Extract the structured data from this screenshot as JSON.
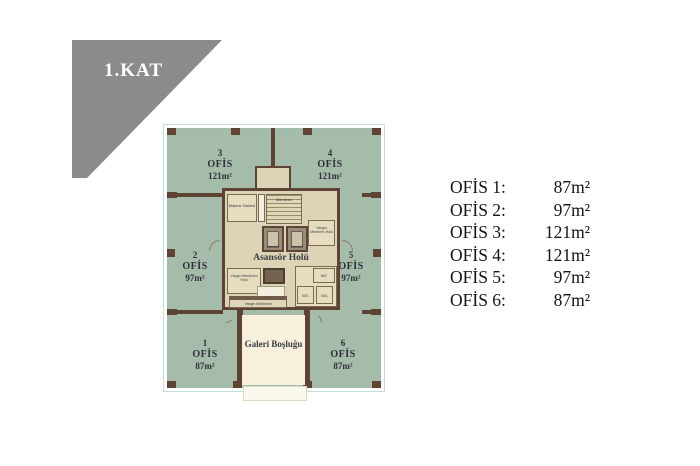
{
  "banner": {
    "label": "1.KAT"
  },
  "plan": {
    "offices": [
      {
        "num": "3",
        "type": "OFİS",
        "area": "121m²"
      },
      {
        "num": "4",
        "type": "OFİS",
        "area": "121m²"
      },
      {
        "num": "2",
        "type": "OFİS",
        "area": "97m²"
      },
      {
        "num": "5",
        "type": "OFİS",
        "area": "97m²"
      },
      {
        "num": "1",
        "type": "OFİS",
        "area": "87m²"
      },
      {
        "num": "6",
        "type": "OFİS",
        "area": "87m²"
      }
    ],
    "core": {
      "hall": "Asansör Holü",
      "machine_room": "Makine Dairesi",
      "stairs": "Merdiven",
      "elevator": "Asansör",
      "fire_hall": "Yangın Merdiveni Holü",
      "fire_stairs": "Yangın Merdiveni",
      "shaft_hall": "Yangın Merdiven Holü",
      "wc": "WC"
    },
    "gallery": "Galeri Boşluğu"
  },
  "legend": {
    "rows": [
      {
        "label": "OFİS 1:",
        "value": "87m²"
      },
      {
        "label": "OFİS 2:",
        "value": "97m²"
      },
      {
        "label": "OFİS 3:",
        "value": "121m²"
      },
      {
        "label": "OFİS 4:",
        "value": "121m²"
      },
      {
        "label": "OFİS 5:",
        "value": "97m²"
      },
      {
        "label": "OFİS 6:",
        "value": "87m²"
      }
    ]
  },
  "colors": {
    "banner_gray": "#8b8b8b",
    "office_green": "#a6bcab",
    "wall_brown": "#5d4334",
    "core_beige": "#ddd3b6",
    "gallery_cream": "#f6f0dd",
    "glass_teal": "#8fb6b4"
  }
}
